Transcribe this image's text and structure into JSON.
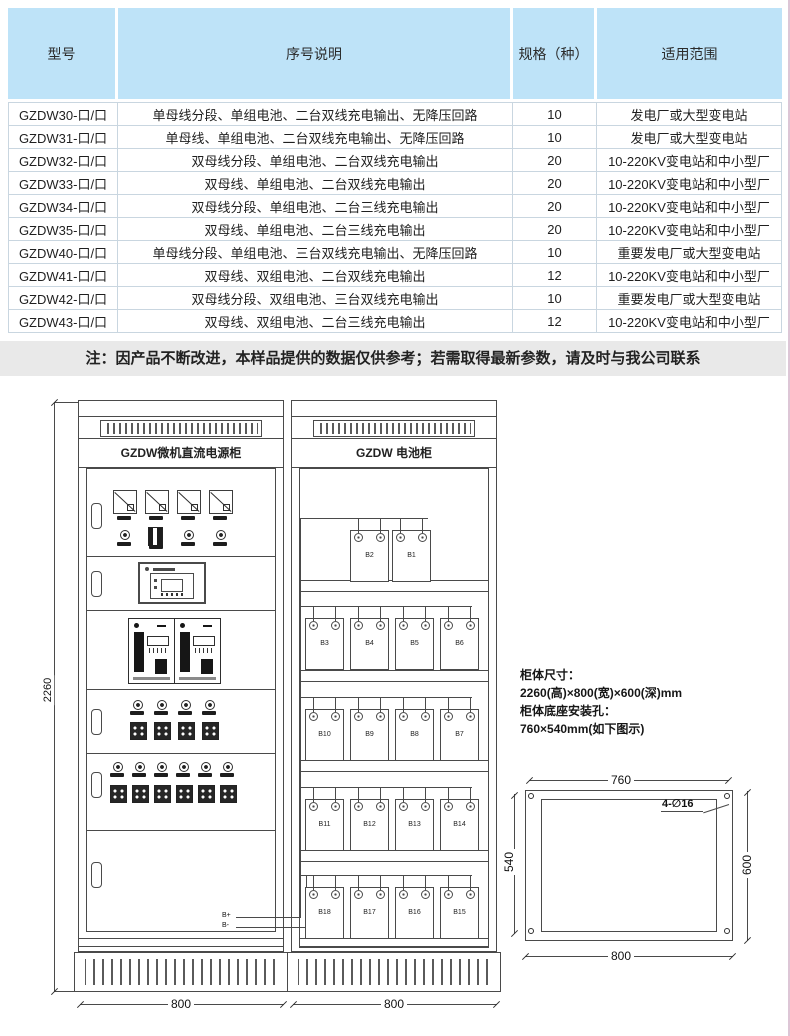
{
  "table": {
    "headers": [
      "型号",
      "序号说明",
      "规格（种）",
      "适用范围"
    ],
    "rows": [
      [
        "GZDW30-口/口",
        "单母线分段、单组电池、二台双线充电输出、无降压回路",
        "10",
        "发电厂或大型变电站"
      ],
      [
        "GZDW31-口/口",
        "单母线、单组电池、二台双线充电输出、无降压回路",
        "10",
        "发电厂或大型变电站"
      ],
      [
        "GZDW32-口/口",
        "双母线分段、单组电池、二台双线充电输出",
        "20",
        "10-220KV变电站和中小型厂"
      ],
      [
        "GZDW33-口/口",
        "双母线、单组电池、二台双线充电输出",
        "20",
        "10-220KV变电站和中小型厂"
      ],
      [
        "GZDW34-口/口",
        "双母线分段、单组电池、二台三线充电输出",
        "20",
        "10-220KV变电站和中小型厂"
      ],
      [
        "GZDW35-口/口",
        "双母线、单组电池、二台三线充电输出",
        "20",
        "10-220KV变电站和中小型厂"
      ],
      [
        "GZDW40-口/口",
        "单母线分段、单组电池、三台双线充电输出、无降压回路",
        "10",
        "重要发电厂或大型变电站"
      ],
      [
        "GZDW41-口/口",
        "双母线、双组电池、二台双线充电输出",
        "12",
        "10-220KV变电站和中小型厂"
      ],
      [
        "GZDW42-口/口",
        "双母线分段、双组电池、三台双线充电输出",
        "10",
        "重要发电厂或大型变电站"
      ],
      [
        "GZDW43-口/口",
        "双母线、双组电池、二台三线充电输出",
        "12",
        "10-220KV变电站和中小型厂"
      ]
    ]
  },
  "note": {
    "text": "注：因产品不断改进，本样品提供的数据仅供参考；若需取得最新参数，请及时与我公司联系"
  },
  "drawing": {
    "power_cabinet": {
      "title": "GZDW微机直流电源柜",
      "width_dim": "800",
      "height_dim": "2260",
      "wire_pos": "B+",
      "wire_neg": "B-"
    },
    "battery_cabinet": {
      "title": "GZDW 电池柜",
      "width_dim": "800",
      "shelves": [
        [
          "B2",
          "B1"
        ],
        [
          "B3",
          "B4",
          "B5",
          "B6"
        ],
        [
          "B10",
          "B9",
          "B8",
          "B7"
        ],
        [
          "B11",
          "B12",
          "B13",
          "B14"
        ],
        [
          "B18",
          "B17",
          "B16",
          "B15"
        ]
      ]
    },
    "specs": {
      "line1": "柜体尺寸：",
      "line2": "2260(高)×800(宽)×600(深)mm",
      "line3": "柜体底座安装孔：",
      "line4": "760×540mm(如下图示)"
    },
    "base_plan": {
      "top_dim": "760",
      "bottom_dim": "800",
      "left_dim": "540",
      "right_dim": "600",
      "hole_callout": "4-∅16"
    }
  },
  "colors": {
    "header_bg": "#bee3f8",
    "note_bg": "#e9e9e9",
    "line": "#4a4a4a"
  }
}
